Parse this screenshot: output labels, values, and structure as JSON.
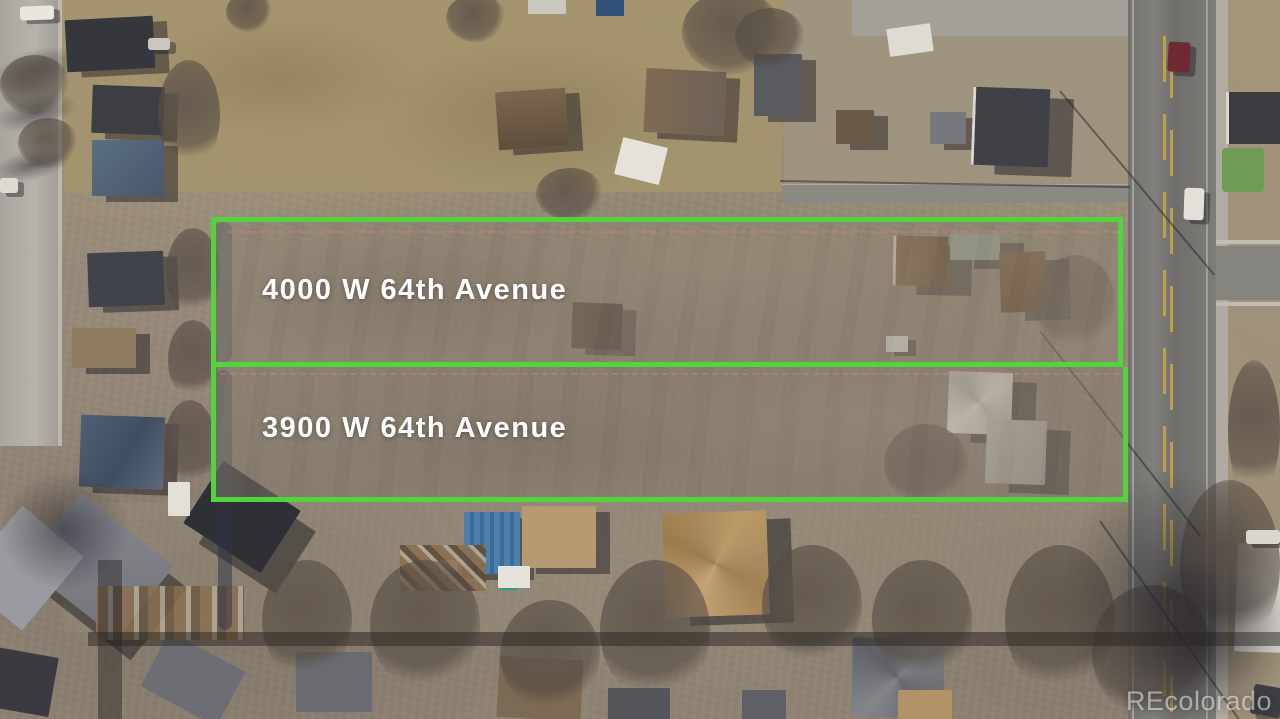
{
  "scene": {
    "description": "Aerial drone photo of two adjacent vacant land parcels outlined in green in a winter residential neighborhood",
    "watermark": "REcolorado"
  },
  "parcels": [
    {
      "label": "4000 W 64th Avenue"
    },
    {
      "label": "3900 W 64th Avenue"
    }
  ],
  "colors": {
    "boundary_green": "#53d43e",
    "parcel_label_text": "#ffffff",
    "survey_line_pink": "rgba(244,130,140,0.6)"
  }
}
